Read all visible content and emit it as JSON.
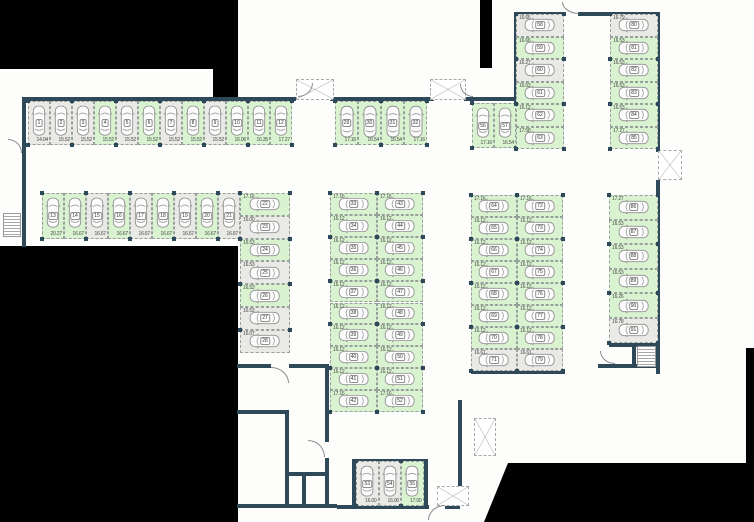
{
  "plan": {
    "title": "Parking floor plan",
    "colors": {
      "highlight_green": "#d9f3d0",
      "space_gray": "#e9e9e6",
      "wall": "#2e4a5a",
      "outside_black": "#000000"
    },
    "groups": [
      {
        "id": "row-1-12",
        "spaces": [
          {
            "n": "1",
            "size": "14.04",
            "state": "gray"
          },
          {
            "n": "2",
            "size": "15.52",
            "state": "gray"
          },
          {
            "n": "3",
            "size": "15.52",
            "state": "gray"
          },
          {
            "n": "4",
            "size": "15.52",
            "state": "green"
          },
          {
            "n": "5",
            "size": "15.52",
            "state": "gray"
          },
          {
            "n": "6",
            "size": "15.52",
            "state": "green"
          },
          {
            "n": "7",
            "size": "15.52",
            "state": "gray"
          },
          {
            "n": "8",
            "size": "15.52",
            "state": "green"
          },
          {
            "n": "9",
            "size": "15.52",
            "state": "gray"
          },
          {
            "n": "10",
            "size": "16.06",
            "state": "green"
          },
          {
            "n": "11",
            "size": "16.35",
            "state": "green"
          },
          {
            "n": "12",
            "size": "17.27",
            "state": "green"
          }
        ]
      },
      {
        "id": "row-29-32",
        "spaces": [
          {
            "n": "29",
            "size": "17.16",
            "state": "green"
          },
          {
            "n": "30",
            "size": "16.54",
            "state": "green"
          },
          {
            "n": "31",
            "size": "16.54",
            "state": "green"
          },
          {
            "n": "32",
            "size": "17.16",
            "state": "green"
          }
        ]
      },
      {
        "id": "row-56-57",
        "spaces": [
          {
            "n": "56",
            "size": "17.16",
            "state": "green"
          },
          {
            "n": "57",
            "size": "16.54",
            "state": "green"
          }
        ]
      },
      {
        "id": "row-13-21",
        "spaces": [
          {
            "n": "13",
            "size": "20.27",
            "state": "green"
          },
          {
            "n": "14",
            "size": "16.67",
            "state": "green"
          },
          {
            "n": "15",
            "size": "16.67",
            "state": "gray"
          },
          {
            "n": "16",
            "size": "16.67",
            "state": "green"
          },
          {
            "n": "17",
            "size": "16.67",
            "state": "gray"
          },
          {
            "n": "18",
            "size": "16.67",
            "state": "green"
          },
          {
            "n": "19",
            "size": "16.67",
            "state": "gray"
          },
          {
            "n": "20",
            "size": "16.67",
            "state": "green"
          },
          {
            "n": "21",
            "size": "16.67",
            "state": "gray"
          }
        ]
      },
      {
        "id": "col-22-28",
        "spaces": [
          {
            "n": "22",
            "size": "17.16",
            "state": "green"
          },
          {
            "n": "23",
            "size": "16.00",
            "state": "gray"
          },
          {
            "n": "24",
            "size": "16.53",
            "state": "green"
          },
          {
            "n": "25",
            "size": "16.53",
            "state": "gray"
          },
          {
            "n": "26",
            "size": "16.53",
            "state": "green"
          },
          {
            "n": "27",
            "size": "16.53",
            "state": "gray"
          },
          {
            "n": "28",
            "size": "16.07",
            "state": "gray"
          }
        ]
      },
      {
        "id": "col-33-42",
        "spaces": [
          {
            "n": "33",
            "size": "17.16",
            "state": "green"
          },
          {
            "n": "34",
            "size": "16.12",
            "state": "green"
          },
          {
            "n": "35",
            "size": "16.12",
            "state": "green"
          },
          {
            "n": "36",
            "size": "16.12",
            "state": "green"
          },
          {
            "n": "37",
            "size": "16.12",
            "state": "green"
          },
          {
            "n": "38",
            "size": "16.12",
            "state": "green"
          },
          {
            "n": "39",
            "size": "16.12",
            "state": "green"
          },
          {
            "n": "40",
            "size": "16.12",
            "state": "green"
          },
          {
            "n": "41",
            "size": "16.12",
            "state": "green"
          },
          {
            "n": "42",
            "size": "17.16",
            "state": "green"
          }
        ]
      },
      {
        "id": "col-43-52",
        "spaces": [
          {
            "n": "43",
            "size": "17.16",
            "state": "green"
          },
          {
            "n": "44",
            "size": "16.12",
            "state": "green"
          },
          {
            "n": "45",
            "size": "16.12",
            "state": "green"
          },
          {
            "n": "46",
            "size": "16.12",
            "state": "green"
          },
          {
            "n": "47",
            "size": "16.12",
            "state": "green"
          },
          {
            "n": "48",
            "size": "16.12",
            "state": "green"
          },
          {
            "n": "49",
            "size": "16.12",
            "state": "green"
          },
          {
            "n": "50",
            "size": "16.12",
            "state": "green"
          },
          {
            "n": "51",
            "size": "16.12",
            "state": "green"
          },
          {
            "n": "52",
            "size": "17.16",
            "state": "green"
          }
        ]
      },
      {
        "id": "row-53-55",
        "spaces": [
          {
            "n": "53",
            "size": "16.00",
            "state": "gray"
          },
          {
            "n": "54",
            "size": "16.00",
            "state": "gray"
          },
          {
            "n": "55",
            "size": "17.00",
            "state": "green"
          }
        ]
      },
      {
        "id": "col-58-63",
        "spaces": [
          {
            "n": "58",
            "size": "16.66",
            "state": "gray"
          },
          {
            "n": "59",
            "size": "16.66",
            "state": "green"
          },
          {
            "n": "60",
            "size": "16.27",
            "state": "gray"
          },
          {
            "n": "61",
            "size": "16.53",
            "state": "green"
          },
          {
            "n": "62",
            "size": "16.12",
            "state": "green"
          },
          {
            "n": "63",
            "size": "17.58",
            "state": "green"
          }
        ]
      },
      {
        "id": "col-64-71",
        "spaces": [
          {
            "n": "64",
            "size": "17.16",
            "state": "green"
          },
          {
            "n": "65",
            "size": "16.12",
            "state": "green"
          },
          {
            "n": "66",
            "size": "16.12",
            "state": "green"
          },
          {
            "n": "67",
            "size": "16.12",
            "state": "green"
          },
          {
            "n": "68",
            "size": "16.12",
            "state": "green"
          },
          {
            "n": "69",
            "size": "16.12",
            "state": "green"
          },
          {
            "n": "70",
            "size": "16.12",
            "state": "green"
          },
          {
            "n": "71",
            "size": "16.61",
            "state": "gray"
          }
        ]
      },
      {
        "id": "col-72-79",
        "spaces": [
          {
            "n": "72",
            "size": "17.16",
            "state": "green"
          },
          {
            "n": "73",
            "size": "16.12",
            "state": "green"
          },
          {
            "n": "74",
            "size": "16.12",
            "state": "green"
          },
          {
            "n": "75",
            "size": "16.12",
            "state": "green"
          },
          {
            "n": "76",
            "size": "16.12",
            "state": "green"
          },
          {
            "n": "77",
            "size": "16.12",
            "state": "green"
          },
          {
            "n": "78",
            "size": "16.12",
            "state": "green"
          },
          {
            "n": "79",
            "size": "16.61",
            "state": "gray"
          }
        ]
      },
      {
        "id": "col-80-85",
        "spaces": [
          {
            "n": "80",
            "size": "16.79",
            "state": "gray"
          },
          {
            "n": "81",
            "size": "16.53",
            "state": "green"
          },
          {
            "n": "82",
            "size": "16.53",
            "state": "green"
          },
          {
            "n": "83",
            "size": "16.53",
            "state": "green"
          },
          {
            "n": "84",
            "size": "16.53",
            "state": "green"
          },
          {
            "n": "85",
            "size": "17.27",
            "state": "green"
          }
        ]
      },
      {
        "id": "col-86-91",
        "spaces": [
          {
            "n": "86",
            "size": "17.27",
            "state": "green"
          },
          {
            "n": "87",
            "size": "16.53",
            "state": "green"
          },
          {
            "n": "88",
            "size": "16.53",
            "state": "green"
          },
          {
            "n": "89",
            "size": "16.53",
            "state": "green"
          },
          {
            "n": "90",
            "size": "16.26",
            "state": "green"
          },
          {
            "n": "91",
            "size": "16.78",
            "state": "gray"
          }
        ]
      }
    ]
  }
}
